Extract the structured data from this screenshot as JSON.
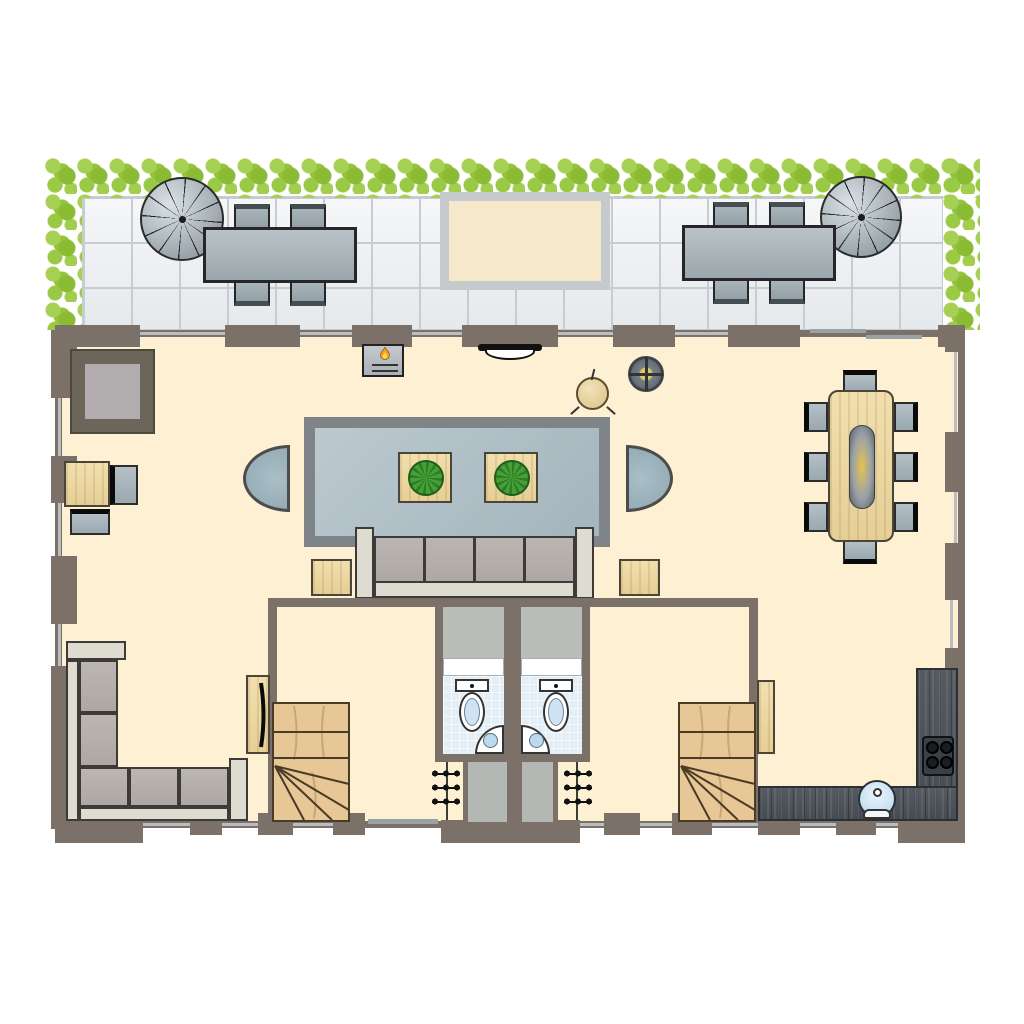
{
  "meta": {
    "type": "floor-plan",
    "canvas": {
      "width": 1024,
      "height": 1024
    }
  },
  "palette": {
    "background": "#ffffff",
    "wall": "#7c7168",
    "floor": "#fdf0d3",
    "terrace_tile": "#eef1f4",
    "tile_line": "#c7ccd1",
    "hedge_dark": "#8abc33",
    "hedge_mid": "#9aca45",
    "hedge_light": "#a6d054",
    "rug_border": "#7f8488",
    "rug_fill": "#aebfc7",
    "wood_light": "#efdaa5",
    "stair_wood": "#e7c795",
    "sofa_frame": "#dedcd0",
    "cushion": "#b7b1ae",
    "seat_gray": "#a9b7be",
    "counter_dark": "#4e545a",
    "bath_floor": "#e4eef6",
    "fixture_blue": "#cfe3f2",
    "vestibule": "#b8bdb7",
    "flame_orange": "#f59f1e",
    "lamp_glow": "#e0c65e",
    "plant_green": "#3f9330",
    "glass": "#b9bec3",
    "sliding_door": "#9aa2a6"
  },
  "inventory": {
    "terrace": [
      {
        "item": "hedge",
        "sides": [
          "top",
          "left",
          "right"
        ]
      },
      {
        "item": "spiral-staircase",
        "count": 2
      },
      {
        "item": "outdoor-dining-table",
        "count": 2,
        "chairs_per_table": 4
      },
      {
        "item": "terrace-mat",
        "count": 1
      }
    ],
    "living_room": [
      {
        "item": "fireplace",
        "count": 1
      },
      {
        "item": "wall-light",
        "count": 1
      },
      {
        "item": "ceiling-lamp",
        "count": 1
      },
      {
        "item": "round-stool",
        "count": 1
      },
      {
        "item": "area-rug",
        "count": 1
      },
      {
        "item": "coffee-table-with-plant",
        "count": 2
      },
      {
        "item": "sofa",
        "seats": 4
      },
      {
        "item": "side-table",
        "count": 2
      },
      {
        "item": "half-round-lounge-chair",
        "count": 2
      },
      {
        "item": "patterned-square-rug",
        "count": 1
      },
      {
        "item": "desk",
        "count": 1
      },
      {
        "item": "desk-chair",
        "count": 2
      },
      {
        "item": "dining-table",
        "count": 1
      },
      {
        "item": "dining-chair",
        "count": 8
      }
    ],
    "lower_level": [
      {
        "item": "corner-sofa",
        "seats": 5
      },
      {
        "item": "wall-tv-panel",
        "count": 1
      },
      {
        "item": "staircase-with-winders",
        "count": 2
      },
      {
        "item": "wc-toilet",
        "count": 2
      },
      {
        "item": "corner-basin",
        "count": 2
      },
      {
        "item": "coat-hook-rack",
        "count": 2
      },
      {
        "item": "entry-corridor",
        "count": 2
      },
      {
        "item": "cabinet-door-panel",
        "count": 1
      }
    ],
    "kitchen": [
      {
        "item": "l-shaped-counter",
        "count": 1
      },
      {
        "item": "cooktop",
        "burners": 4
      },
      {
        "item": "round-sink",
        "count": 1
      }
    ]
  }
}
